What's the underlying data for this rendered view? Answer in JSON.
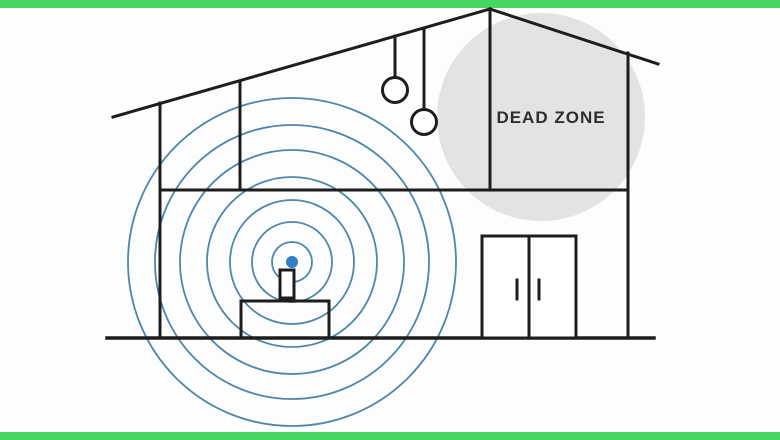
{
  "illustration": {
    "title": "Wi-Fi dead zone house diagram",
    "dead_zone": {
      "label": "DEAD ZONE"
    },
    "signal": {
      "ring_count": 7,
      "ring_radii": [
        20,
        40,
        62,
        85,
        112,
        137,
        164
      ],
      "center_x": 292,
      "center_y": 262
    }
  },
  "colors": {
    "background": "#fdfdfd",
    "frame_green": "#47d661",
    "house_line": "#1d1d1d",
    "signal_ring": "#4d87ab",
    "router_dot": "#2e7fc6",
    "dead_zone_fill": "#e3e3e3",
    "dead_zone_text": "#2e2e2e"
  }
}
